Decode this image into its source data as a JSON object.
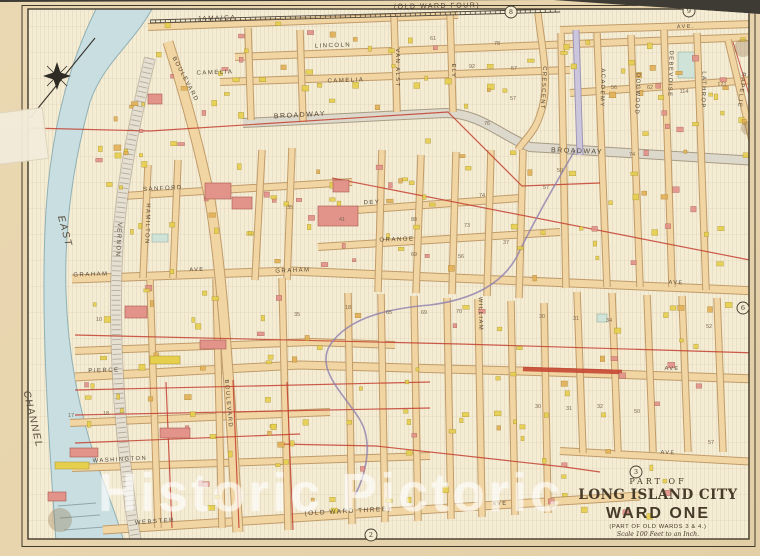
{
  "title_block": {
    "part_of": "PART OF",
    "city": "LONG ISLAND CITY",
    "ward": "WARD ONE",
    "subtitle": "(PART OF OLD WARDS 3 & 4.)",
    "scale": "Scale 100 Feet to an Inch."
  },
  "watermark": "Historic Pictoric",
  "banners": {
    "top": "(OLD WARD FOUR)",
    "bottom": "(OLD WARD THREE)"
  },
  "water": {
    "name_upper": "EAST",
    "name_lower": "CHANNEL"
  },
  "street_labels": [
    {
      "t": "JAMAICA",
      "x": 217,
      "y": 20,
      "r": -2,
      "s": 6.5
    },
    {
      "t": "AVE.",
      "x": 686,
      "y": 28,
      "r": -2,
      "s": 5.5
    },
    {
      "t": "LINCOLN",
      "x": 333,
      "y": 47,
      "r": -2,
      "s": 6
    },
    {
      "t": "CAMELIA",
      "x": 215,
      "y": 74,
      "r": -2,
      "s": 6
    },
    {
      "t": "CAMELIA",
      "x": 346,
      "y": 82,
      "r": -2,
      "s": 6
    },
    {
      "t": "BROADWAY",
      "x": 300,
      "y": 117,
      "r": -3,
      "s": 7
    },
    {
      "t": "BROADWAY",
      "x": 577,
      "y": 153,
      "r": 2,
      "s": 7
    },
    {
      "t": "SANFORD",
      "x": 163,
      "y": 190,
      "r": -3,
      "s": 6
    },
    {
      "t": "DEY",
      "x": 372,
      "y": 204,
      "r": -2,
      "s": 6
    },
    {
      "t": "ORANGE",
      "x": 397,
      "y": 241,
      "r": -2,
      "s": 6
    },
    {
      "t": "GRAHAM",
      "x": 91,
      "y": 276,
      "r": -2,
      "s": 6
    },
    {
      "t": "AVE",
      "x": 197,
      "y": 271,
      "r": -2,
      "s": 5.5
    },
    {
      "t": "GRAHAM",
      "x": 293,
      "y": 272,
      "r": -2,
      "s": 6
    },
    {
      "t": "AVE",
      "x": 676,
      "y": 284,
      "r": 2,
      "s": 5.5
    },
    {
      "t": "PIERCE",
      "x": 104,
      "y": 372,
      "r": -2,
      "s": 6
    },
    {
      "t": "AVE",
      "x": 672,
      "y": 370,
      "r": 1,
      "s": 5.5
    },
    {
      "t": "WASHINGTON",
      "x": 120,
      "y": 461,
      "r": -3,
      "s": 5.8
    },
    {
      "t": "AVE",
      "x": 668,
      "y": 454,
      "r": 2,
      "s": 5.5
    },
    {
      "t": "WEBSTER",
      "x": 155,
      "y": 523,
      "r": -4,
      "s": 6
    },
    {
      "t": "AVE",
      "x": 500,
      "y": 505,
      "r": -3,
      "s": 5.5
    },
    {
      "t": "VAN ALST",
      "x": 396,
      "y": 68,
      "r": 90,
      "s": 5.8
    },
    {
      "t": "ELY",
      "x": 452,
      "y": 71,
      "r": 90,
      "s": 5.8
    },
    {
      "t": "CRESCENT",
      "x": 542,
      "y": 88,
      "r": 93,
      "s": 5.8
    },
    {
      "t": "ACADEMY",
      "x": 601,
      "y": 88,
      "r": 92,
      "s": 5.8
    },
    {
      "t": "DOGWOOD",
      "x": 636,
      "y": 94,
      "r": 92,
      "s": 5.8
    },
    {
      "t": "DEBEVOISE",
      "x": 669,
      "y": 74,
      "r": 92,
      "s": 5.8
    },
    {
      "t": "LATHROP",
      "x": 702,
      "y": 90,
      "r": 92,
      "s": 5.8
    },
    {
      "t": "RAPELJE",
      "x": 740,
      "y": 90,
      "r": 97,
      "s": 5.8
    },
    {
      "t": "VERNON",
      "x": 117,
      "y": 240,
      "r": 93,
      "s": 6
    },
    {
      "t": "HAMILTON",
      "x": 146,
      "y": 224,
      "r": 92,
      "s": 5.8
    },
    {
      "t": "BOULEVARD",
      "x": 184,
      "y": 80,
      "r": 62,
      "s": 6
    },
    {
      "t": "BOULEVARD",
      "x": 227,
      "y": 404,
      "r": 85,
      "s": 5.8
    },
    {
      "t": "WILLIAM",
      "x": 479,
      "y": 314,
      "r": 89,
      "s": 5.8
    }
  ],
  "block_numbers": [
    {
      "t": "61",
      "x": 433,
      "y": 40
    },
    {
      "t": "78",
      "x": 497,
      "y": 45
    },
    {
      "t": "57",
      "x": 514,
      "y": 70
    },
    {
      "t": "57",
      "x": 513,
      "y": 100
    },
    {
      "t": "92",
      "x": 472,
      "y": 68
    },
    {
      "t": "76",
      "x": 487,
      "y": 125
    },
    {
      "t": "59",
      "x": 560,
      "y": 172
    },
    {
      "t": "57",
      "x": 546,
      "y": 189
    },
    {
      "t": "74",
      "x": 632,
      "y": 156
    },
    {
      "t": "74",
      "x": 482,
      "y": 197
    },
    {
      "t": "73",
      "x": 467,
      "y": 227
    },
    {
      "t": "37",
      "x": 506,
      "y": 244
    },
    {
      "t": "88",
      "x": 414,
      "y": 221
    },
    {
      "t": "69",
      "x": 414,
      "y": 256
    },
    {
      "t": "56",
      "x": 461,
      "y": 258
    },
    {
      "t": "35",
      "x": 290,
      "y": 209
    },
    {
      "t": "41",
      "x": 342,
      "y": 221
    },
    {
      "t": "56",
      "x": 614,
      "y": 89
    },
    {
      "t": "62",
      "x": 650,
      "y": 89
    },
    {
      "t": "114",
      "x": 684,
      "y": 93
    },
    {
      "t": "121",
      "x": 722,
      "y": 86
    },
    {
      "t": "18",
      "x": 348,
      "y": 309
    },
    {
      "t": "65",
      "x": 389,
      "y": 314
    },
    {
      "t": "69",
      "x": 424,
      "y": 314
    },
    {
      "t": "70",
      "x": 459,
      "y": 313
    },
    {
      "t": "30",
      "x": 542,
      "y": 318
    },
    {
      "t": "31",
      "x": 576,
      "y": 320
    },
    {
      "t": "34",
      "x": 609,
      "y": 322
    },
    {
      "t": "52",
      "x": 709,
      "y": 328
    },
    {
      "t": "30",
      "x": 538,
      "y": 408
    },
    {
      "t": "31",
      "x": 569,
      "y": 410
    },
    {
      "t": "32",
      "x": 600,
      "y": 408
    },
    {
      "t": "50",
      "x": 637,
      "y": 413
    },
    {
      "t": "10",
      "x": 99,
      "y": 321
    },
    {
      "t": "35",
      "x": 297,
      "y": 316
    },
    {
      "t": "17",
      "x": 71,
      "y": 417
    },
    {
      "t": "18",
      "x": 106,
      "y": 415
    },
    {
      "t": "57",
      "x": 711,
      "y": 444
    }
  ],
  "plate_markers": [
    {
      "t": "8",
      "x": 511,
      "y": 12
    },
    {
      "t": "9",
      "x": 689,
      "y": 11
    },
    {
      "t": "6",
      "x": 743,
      "y": 308
    },
    {
      "t": "3",
      "x": 636,
      "y": 472
    },
    {
      "t": "2",
      "x": 371,
      "y": 535
    }
  ]
}
